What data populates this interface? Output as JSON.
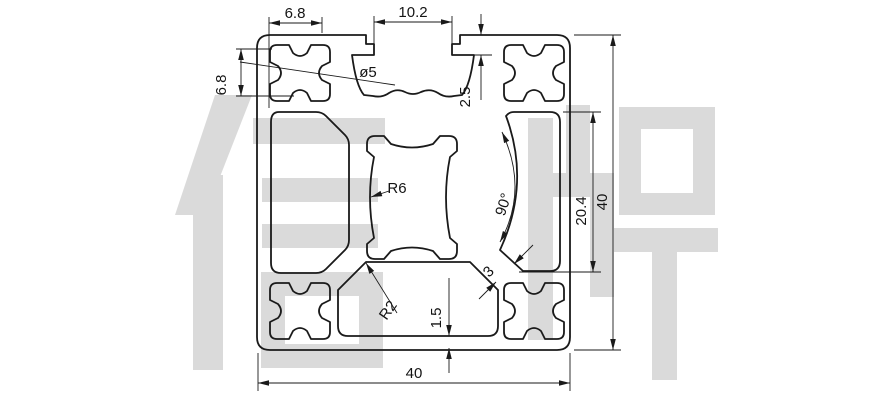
{
  "drawing": {
    "kind": "technical-drawing",
    "subject": "aluminum extrusion profile 4040 cross-section",
    "watermark": "信牌",
    "colors": {
      "line": "#1a1a1a",
      "watermark": "#dadada",
      "background": "#ffffff"
    },
    "dimensions": {
      "top_slot_offset": "6.8",
      "slot_opening": "10.2",
      "boss_height": "6.8",
      "corner_hole": "ø5",
      "lip_thickness": "2.5",
      "center_radius": "R6",
      "groove_angle": "90°",
      "inner_height": "20.4",
      "height": "40",
      "bottom_radius": "R2",
      "bottom_wall": "1.5",
      "web": "3",
      "width": "40"
    }
  }
}
